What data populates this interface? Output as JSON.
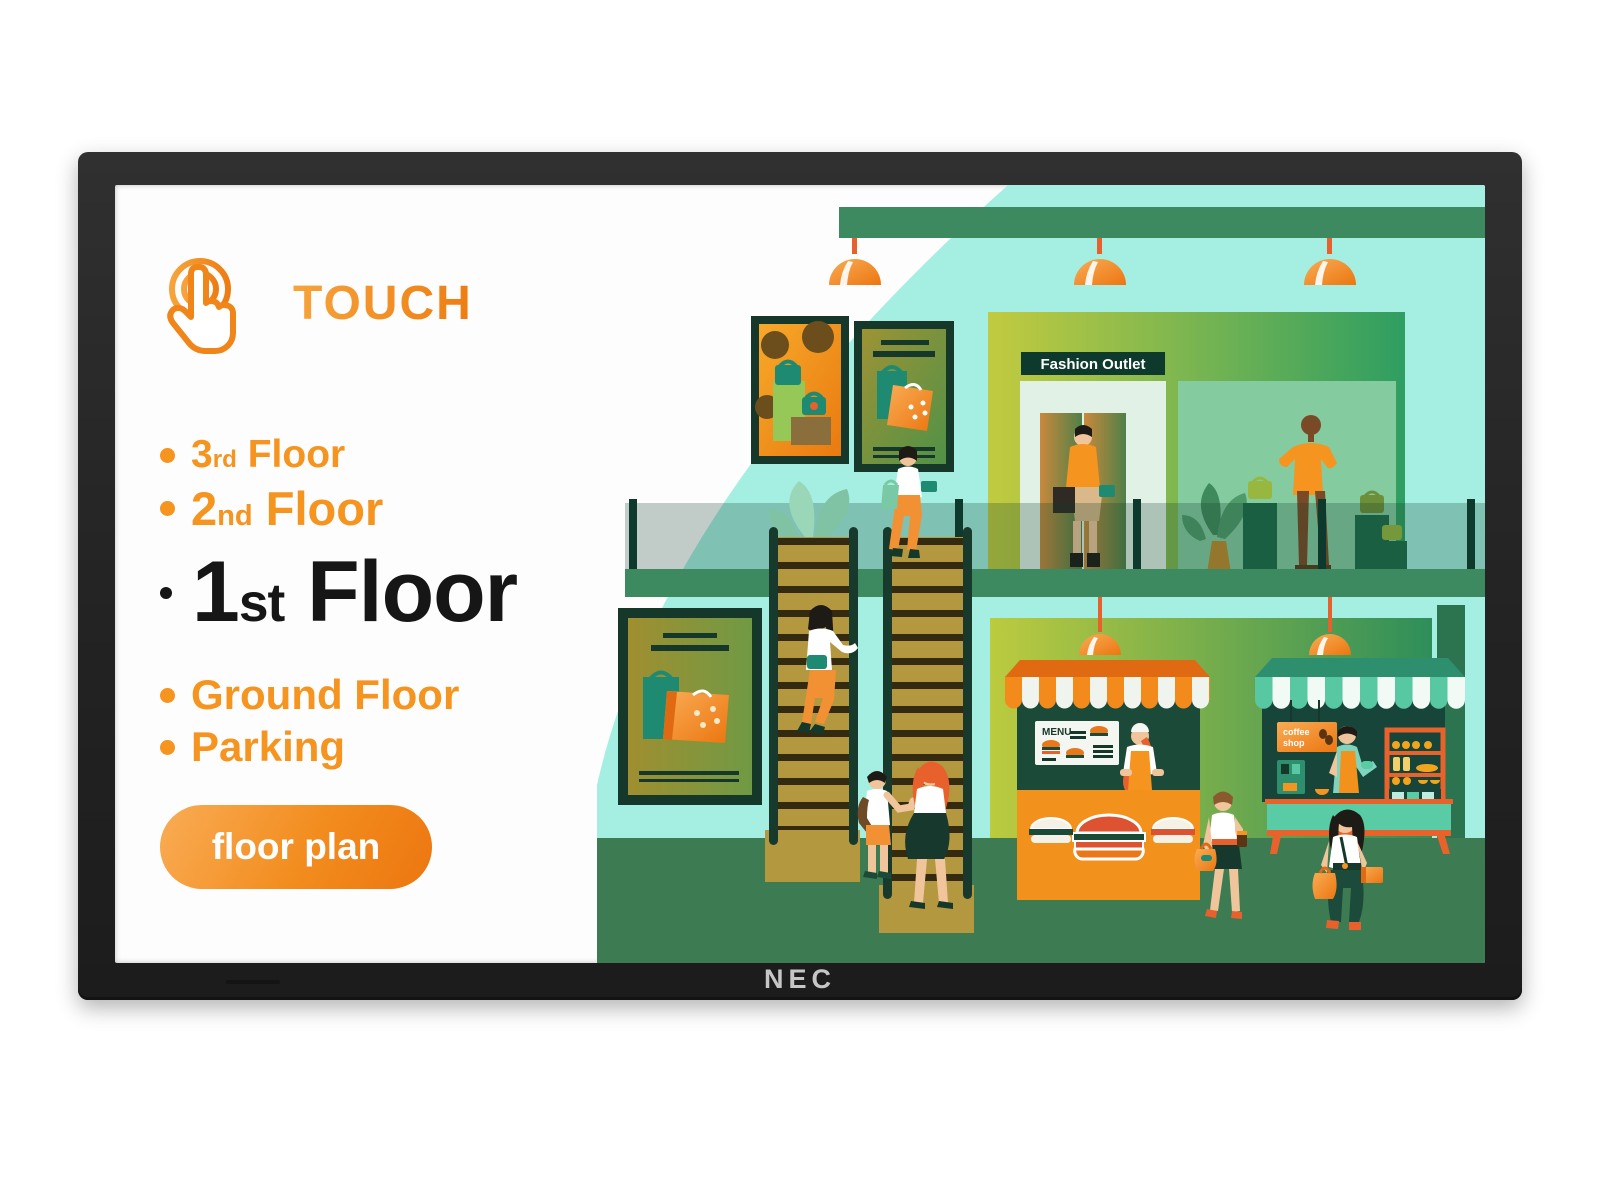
{
  "monitor": {
    "brand": "NEC"
  },
  "panel": {
    "touch_label": "TOUCH",
    "floors": [
      {
        "num": "3",
        "ord": "rd",
        "name": " Floor",
        "active": false
      },
      {
        "num": "2",
        "ord": "nd",
        "name": " Floor",
        "active": false
      },
      {
        "num": "1",
        "ord": "st",
        "name": " Floor",
        "active": true
      },
      {
        "num": "",
        "ord": "",
        "name": "Ground Floor",
        "active": false
      },
      {
        "num": "",
        "ord": "",
        "name": "Parking",
        "active": false
      }
    ],
    "button_label": "floor plan"
  },
  "mall": {
    "fashion_sign": "Fashion Outlet",
    "menu_sign": "MENU",
    "coffee_sign_line1": "coffee",
    "coffee_sign_line2": "shop"
  },
  "colors": {
    "accent_orange": "#F5941F",
    "deep_orange": "#EC7610",
    "mint": "#A4EFE1",
    "green_beam": "#3D8A60",
    "green_floor": "#3D7B52",
    "dark_green": "#16382A",
    "stair_gold": "#B3983F",
    "awning_teal": "#57C8A2",
    "active_text": "#161616",
    "bezel": "#262626"
  }
}
